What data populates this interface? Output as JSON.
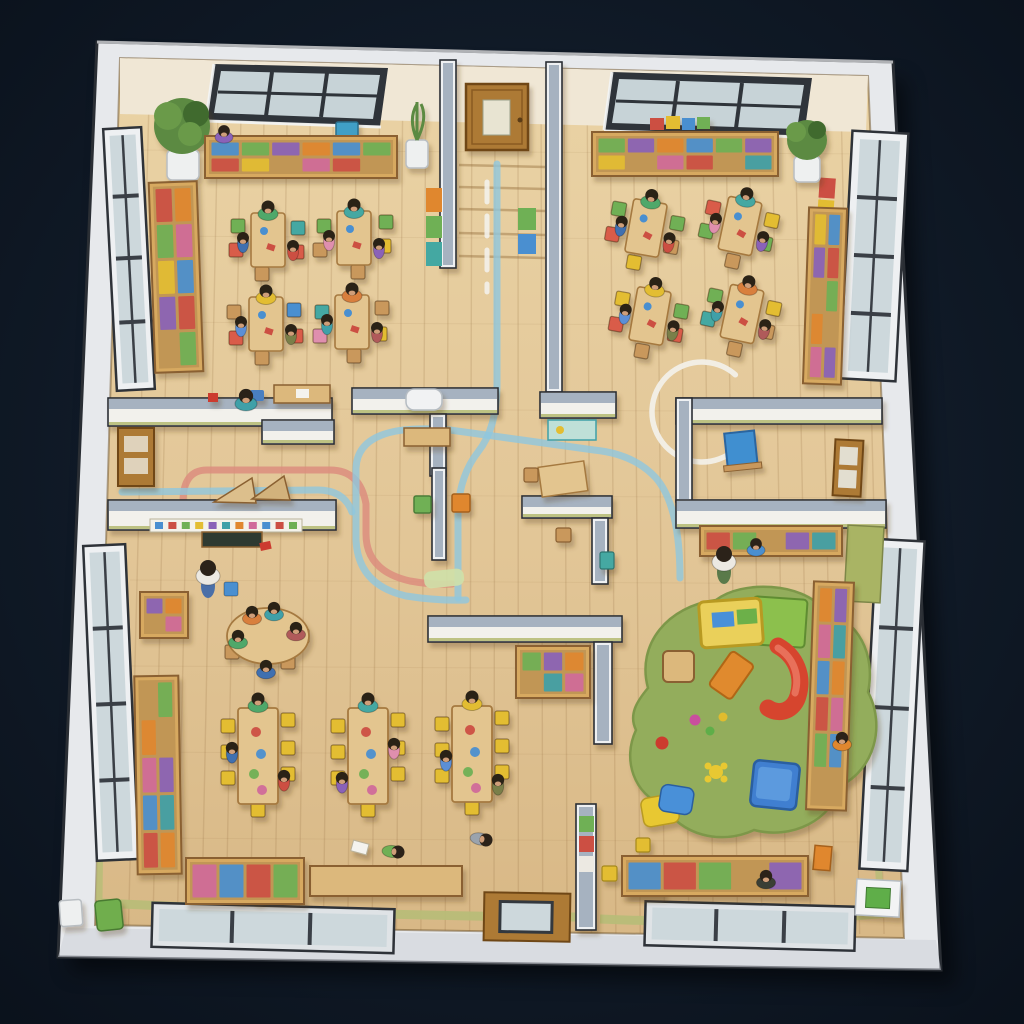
{
  "scene": {
    "title": "Kindergarten floor plan - top-down 3D cutaway view",
    "style": "rendered dollhouse illustration on a dark navy background, no visible text",
    "rooms": [
      {
        "id": "classroom-top-left",
        "features": [
          "skylight window in top wall",
          "long wall shelf with toy bins",
          "potted plant in white pot",
          "tall side window",
          "tall bookshelf along left wall",
          "4 small rectangular activity tables with seated children",
          "colored kid chairs",
          "standing child",
          "small desk and wedge blocks in alcove",
          "wooden door on left wall"
        ]
      },
      {
        "id": "classroom-top-right",
        "features": [
          "skylight window in top wall",
          "long wall shelf with books",
          "potted plant",
          "tall side window",
          "tall bookshelf along right wall",
          "colorful wall hanging",
          "4 small rectangular activity tables with seated children",
          "reading nook with blue easel and interior door"
        ]
      },
      {
        "id": "classroom-bottom-left",
        "features": [
          "alphabet frieze and chalkboard on top wall",
          "teacher figure",
          "oval group table with children",
          "3 long tables with yellow chairs and children",
          "tall window",
          "tall bookshelf",
          "toy bin box with tricycle",
          "low wooden bench",
          "children playing on floor",
          "bottom wall windows"
        ]
      },
      {
        "id": "playroom-bottom-right",
        "features": [
          "large green organic-shaped play rug",
          "climbing frame with red and orange slides",
          "wooden stool",
          "blue cube seat",
          "floor cushions",
          "scattered toys and ball",
          "tall toy shelf",
          "long toy bench with bins",
          "tall side window",
          "bottom wall window",
          "teacher at cubby bench"
        ]
      },
      {
        "id": "central-corridor",
        "features": [
          "entry door at top with steps",
          "partition walls with gray caps",
          "red and blue play-road floor tracks",
          "white dashed center line",
          "white painted circle",
          "small activity nooks with tables and chairs",
          "green floor mat"
        ]
      }
    ],
    "counts": {
      "small_tables": 8,
      "long_tables": 3,
      "oval_tables": 1,
      "children_visible_approx": 45,
      "adults_visible": 2,
      "skylights": 2,
      "side_windows": 4,
      "bottom_wall_windows": 2,
      "doors": 4,
      "potted_plants": 3,
      "bookshelves": 7,
      "play_rugs": 1,
      "slides": 1
    }
  },
  "palette": {
    "background_dark": "#0d1520",
    "background_glow": "#1b2534",
    "outer_wall": "#e7e9ec",
    "outer_wall_shade": "#cdd2d8",
    "outer_wall_edge": "#2a2e34",
    "wall_face": "#f2f1ec",
    "wall_cap": "#a6b2c0",
    "wall_trim_white": "#eef0f2",
    "top_wall_cream": "#f0e7d5",
    "floor_light": "#ead3a5",
    "floor_dark": "#d8b886",
    "plank_line": "rgba(140,100,55,0.18)",
    "baseboard_green": "#b7bd78",
    "accent_olive": "#a9b464",
    "window_frame_dark": "#33383e",
    "window_frame_white": "#eef0f2",
    "glass": "#cdd8dc",
    "glass_sky": "#c7d3d7",
    "door_wood": "#ad7a35",
    "door_edge": "#6f4716",
    "shelf_wood": "#d7a960",
    "shelf_edge": "#8a6131",
    "table_wood": "#e3c58f",
    "table_edge": "#a5793f",
    "bench_wood": "#dcb87c",
    "rug_green": "#93ad5c",
    "rug_edge": "#7d9748",
    "slide_red": "#d6452f",
    "slide_red_light": "#e8705a",
    "slide_orange": "#e08a2e",
    "slide_yellow": "#ead05a",
    "slide_green": "#8cc04e",
    "track_red": "#dc8d7e",
    "track_blue": "#8ec7de",
    "track_white": "#f3f1ea",
    "chair_green": "#6fb055",
    "chair_red": "#d95c4a",
    "chair_yellow": "#e3bd32",
    "chair_teal": "#44a8a2",
    "chair_blue": "#4a8fd0",
    "chair_pink": "#df8fae",
    "chair_wood": "#c9985c",
    "chair_orange": "#e0872e",
    "item_blue": "#4a8fd0",
    "item_red": "#cc4f43",
    "item_green": "#6fb055",
    "item_yellow": "#e3bd32",
    "item_purple": "#8a62b8",
    "item_teal": "#3fa0a8",
    "item_orange": "#e0872e",
    "item_pink": "#d06a9a",
    "skin": "#d8a57e",
    "hair": "#2b2219",
    "shirt_white": "#ece9e2",
    "shirt_gray": "#9aa3ad",
    "pants_blue": "#4a6fa8",
    "plant_green": "#5b8a42",
    "plant_dark": "#3f6b2e",
    "pot_white": "#eef0f0",
    "easel_blue": "#3f8fd0",
    "blackboard": "#2e3a31",
    "kid_shirts": [
      "#4fa86a",
      "#3f6fb0",
      "#cc4f43",
      "#44a8a2",
      "#df8fae",
      "#8a62b8",
      "#e3bd32",
      "#5b8fd6",
      "#7a7f4a",
      "#d87f3e",
      "#3fa0a8",
      "#b05a5a"
    ]
  }
}
